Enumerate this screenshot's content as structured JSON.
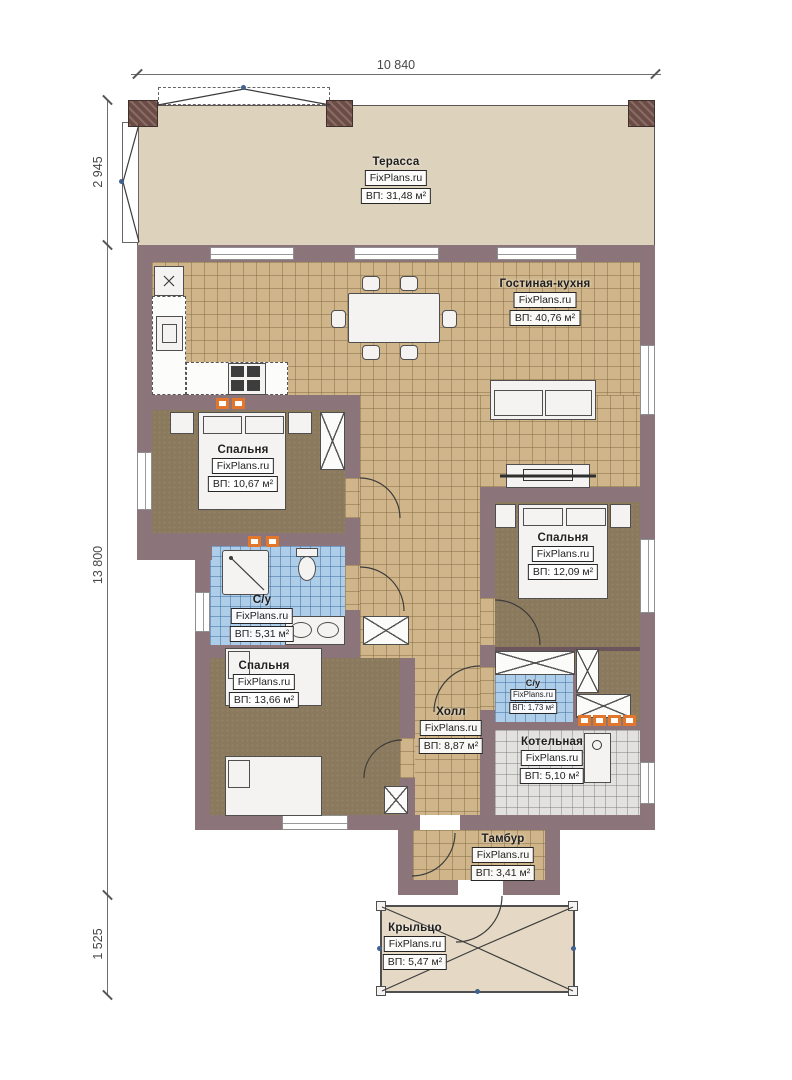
{
  "brand": "FixPlans.ru",
  "dims": {
    "top": "10 840",
    "left": [
      "2 945",
      "13 800",
      "1 525"
    ]
  },
  "rooms": [
    {
      "id": "terrace",
      "name": "Терасса",
      "brand": "FixPlans.ru",
      "area": "ВП: 31,48 м²"
    },
    {
      "id": "living",
      "name": "Гостиная-кухня",
      "brand": "FixPlans.ru",
      "area": "ВП: 40,76 м²"
    },
    {
      "id": "bedroom1",
      "name": "Спальня",
      "brand": "FixPlans.ru",
      "area": "ВП: 10,67 м²"
    },
    {
      "id": "bath1",
      "name": "С/у",
      "brand": "FixPlans.ru",
      "area": "ВП: 5,31 м²"
    },
    {
      "id": "bedroom3",
      "name": "Спальня",
      "brand": "FixPlans.ru",
      "area": "ВП: 13,66 м²"
    },
    {
      "id": "bedroom2",
      "name": "Спальня",
      "brand": "FixPlans.ru",
      "area": "ВП: 12,09 м²"
    },
    {
      "id": "hall",
      "name": "Холл",
      "brand": "FixPlans.ru",
      "area": "ВП: 8,87 м²"
    },
    {
      "id": "bath2",
      "name": "С/у",
      "brand": "FixPlans.ru",
      "area": "ВП: 1,73 м²"
    },
    {
      "id": "boiler",
      "name": "Котельная",
      "brand": "FixPlans.ru",
      "area": "ВП: 5,10 м²"
    },
    {
      "id": "tambour",
      "name": "Тамбур",
      "brand": "FixPlans.ru",
      "area": "ВП: 3,41 м²"
    },
    {
      "id": "porch",
      "name": "Крыльцо",
      "brand": "FixPlans.ru",
      "area": "ВП: 5,47 м²"
    }
  ],
  "colors": {
    "wall": "#8b757b",
    "terrace_floor": "#ddd2bc",
    "tile_tan": "#cfb589",
    "floor_brown": "#8a795c",
    "tile_blue": "#aecde9",
    "tile_gray": "#e2e1df",
    "porch_floor": "#e5d9c5",
    "vent_orange": "#e2762c",
    "column_brown": "#6d4c45"
  }
}
